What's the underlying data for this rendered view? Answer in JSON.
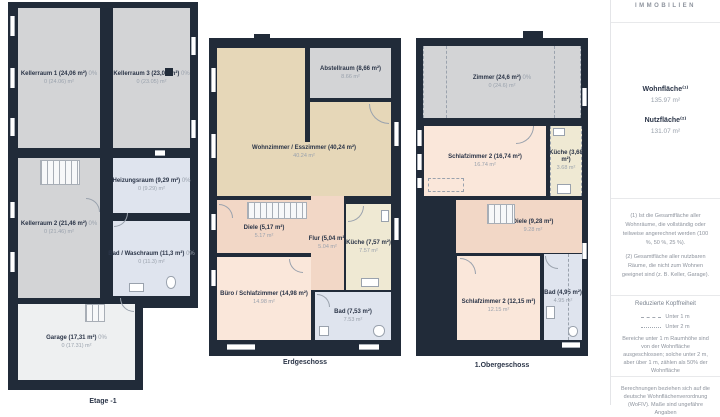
{
  "brand": "IMMOBILIEN",
  "sidebar": {
    "metrics": [
      {
        "label": "Wohnfläche⁽¹⁾",
        "value": "135.97 m²"
      },
      {
        "label": "Nutzfläche⁽²⁾",
        "value": "131.07 m²"
      }
    ],
    "notes": [
      "(1) Ist die Gesamtfläche aller Wohnräume, die vollständig oder teilweise angerechnet werden (100 %, 50 %, 25 %).",
      "(2) Gesamtfläche aller nutzbaren Räume, die nicht zum Wohnen geeignet sind (z. B. Keller, Garage)."
    ],
    "headroom": {
      "title": "Reduzierte Kopffreiheit",
      "legend": [
        {
          "label": "Unter 1 m"
        },
        {
          "label": "Unter 2 m"
        }
      ],
      "text": "Bereiche unter 1 m Raumhöhe sind von der Wohnfläche ausgeschlossen; solche unter 2 m, aber über 1 m, zählen als 50% der Wohnfläche"
    },
    "footer": "Berechnungen beziehen sich auf die deutsche Wohnflächenverordnung (WoFlV). Maße sind ungefähre Angaben"
  },
  "colors": {
    "wall": "#212b39",
    "room_gray": "#d3d4d6",
    "room_blue": "#dfe4ee",
    "room_tan": "#e6d7b8",
    "room_salmon": "#f2d7c6",
    "room_pink": "#fae7da",
    "room_cream": "#efe9d3",
    "room_garage": "#eef0f1"
  },
  "floors": [
    {
      "caption": "Etage -1",
      "rooms": [
        {
          "title": "Kellerraum 1 (24,06 m²)",
          "pct": "0%",
          "value": "0 (24.06) m²"
        },
        {
          "title": "Kellerraum 3 (23,05 m²)",
          "pct": "0%",
          "value": "0 (23.05) m²"
        },
        {
          "title": "Heizungsraum (9,29 m²)",
          "pct": "0%",
          "value": "0 (9.29) m²"
        },
        {
          "title": "Kellerraum 2 (21,46 m²)",
          "pct": "0%",
          "value": "0 (21.46) m²"
        },
        {
          "title": "Bad / Waschraum (11,3 m²)",
          "pct": "0%",
          "value": "0 (11.3) m²"
        },
        {
          "title": "Garage (17,31 m²)",
          "pct": "0%",
          "value": "0 (17.31) m²"
        }
      ]
    },
    {
      "caption": "Erdgeschoss",
      "rooms": [
        {
          "title": "Abstellraum (8,66 m²)",
          "pct": "",
          "value": "8.66 m²"
        },
        {
          "title": "Wohnzimmer / Esszimmer (40,24 m²)",
          "pct": "",
          "value": "40.24 m²"
        },
        {
          "title": "Diele (5,17 m²)",
          "pct": "",
          "value": "5.17 m²"
        },
        {
          "title": "Flur (5,04 m²)",
          "pct": "",
          "value": "5.04 m²"
        },
        {
          "title": "Küche (7,57 m²)",
          "pct": "",
          "value": "7.57 m²"
        },
        {
          "title": "Büro / Schlafzimmer (14,98 m²)",
          "pct": "",
          "value": "14.98 m²"
        },
        {
          "title": "Bad (7,53 m²)",
          "pct": "",
          "value": "7.53 m²"
        }
      ]
    },
    {
      "caption": "1.Obergeschoss",
      "rooms": [
        {
          "title": "Zimmer (24,6 m²)",
          "pct": "0%",
          "value": "0 (24.6) m²"
        },
        {
          "title": "Schlafzimmer 2 (16,74 m²)",
          "pct": "",
          "value": "16.74 m²"
        },
        {
          "title": "Küche (3,68 m²)",
          "pct": "",
          "value": "3.68 m²"
        },
        {
          "title": "Diele (9,28 m²)",
          "pct": "",
          "value": "9.28 m²"
        },
        {
          "title": "Schlafzimmer 2 (12,15 m²)",
          "pct": "",
          "value": "12.15 m²"
        },
        {
          "title": "Bad (4,95 m²)",
          "pct": "",
          "value": "4.95 m²"
        }
      ]
    }
  ]
}
